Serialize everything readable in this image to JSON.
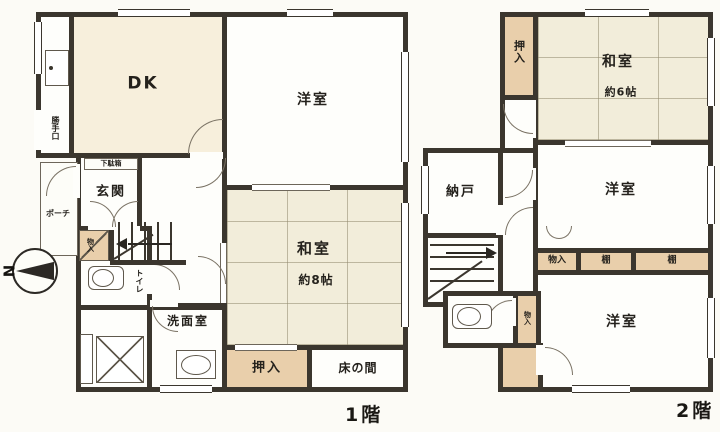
{
  "compass": {
    "north": "N"
  },
  "floor1": {
    "caption": "1階",
    "rooms": {
      "dk": "DK",
      "western": "洋室",
      "entrance": "玄関",
      "shoe_cabinet": "下駄箱",
      "porch": "ポーチ",
      "back_door": "勝手口",
      "understairs_storage": "物入",
      "toilet": "トイレ",
      "washroom": "洗面室",
      "japanese": "和室",
      "japanese_size": "約8帖",
      "closet": "押入",
      "alcove": "床の間"
    }
  },
  "floor2": {
    "caption": "2階",
    "rooms": {
      "closet": "押入",
      "japanese": "和室",
      "japanese_size": "約6帖",
      "storage_room": "納戸",
      "western_middle": "洋室",
      "storage": "物入",
      "shelf_left": "棚",
      "shelf_right": "棚",
      "western_bottom": "洋室",
      "storage_small": "物入"
    }
  }
}
